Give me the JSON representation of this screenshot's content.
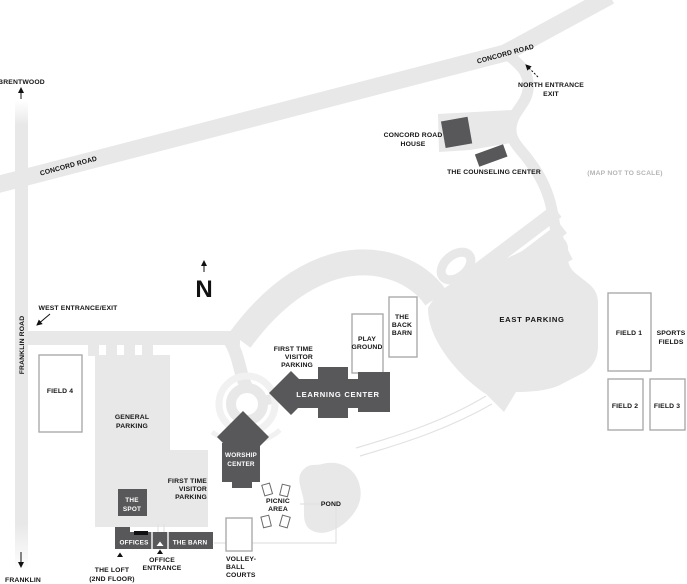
{
  "map_note": "(MAP NOT TO SCALE)",
  "compass": {
    "label": "N"
  },
  "colors": {
    "road_gray": "#e8e8e8",
    "building_gray": "#58585a",
    "label_black": "#141414",
    "note_gray": "#b5b5b5",
    "field_border": "#ababab"
  },
  "roads": {
    "concord_upper": "CONCORD ROAD",
    "concord_lower": "CONCORD ROAD",
    "franklin": "FRANKLIN ROAD"
  },
  "offmap": {
    "north_city": "BRENTWOOD",
    "south_city": "FRANKLIN"
  },
  "entrances": {
    "west": "WEST ENTRANCE/EXIT",
    "north_line1": "NORTH ENTRANCE",
    "north_line2": "EXIT",
    "office_line1": "OFFICE",
    "office_line2": "ENTRANCE"
  },
  "buildings": {
    "learning_center": {
      "label": "LEARNING CENTER"
    },
    "worship_center": {
      "line1": "WORSHIP",
      "line2": "CENTER"
    },
    "the_spot": {
      "line1": "THE",
      "line2": "SPOT"
    },
    "offices": {
      "label": "OFFICES"
    },
    "the_barn": {
      "label": "THE BARN"
    },
    "the_loft": {
      "line1": "THE LOFT",
      "line2": "(2ND FLOOR)"
    },
    "concord_road_house": {
      "line1": "CONCORD ROAD",
      "line2": "HOUSE"
    },
    "counseling_center": {
      "label": "THE COUNSELING CENTER"
    }
  },
  "parking": {
    "east": {
      "label": "EAST PARKING"
    },
    "general": {
      "line1": "GENERAL",
      "line2": "PARKING"
    },
    "first_time_visitor_north": {
      "line1": "FIRST TIME",
      "line2": "VISITOR",
      "line3": "PARKING"
    },
    "first_time_visitor_south": {
      "line1": "FIRST TIME",
      "line2": "VISITOR",
      "line3": "PARKING"
    }
  },
  "recreation": {
    "play_ground": {
      "line1": "PLAY",
      "line2": "GROUND"
    },
    "back_barn": {
      "line1": "THE",
      "line2": "BACK",
      "line3": "BARN"
    },
    "field1": "FIELD 1",
    "field2": "FIELD 2",
    "field3": "FIELD 3",
    "field4": "FIELD 4",
    "sports_fields": {
      "line1": "SPORTS",
      "line2": "FIELDS"
    },
    "volleyball": {
      "line1": "VOLLEY-",
      "line2": "BALL",
      "line3": "COURTS"
    },
    "picnic": {
      "line1": "PICNIC",
      "line2": "AREA"
    },
    "pond": {
      "label": "POND"
    }
  }
}
